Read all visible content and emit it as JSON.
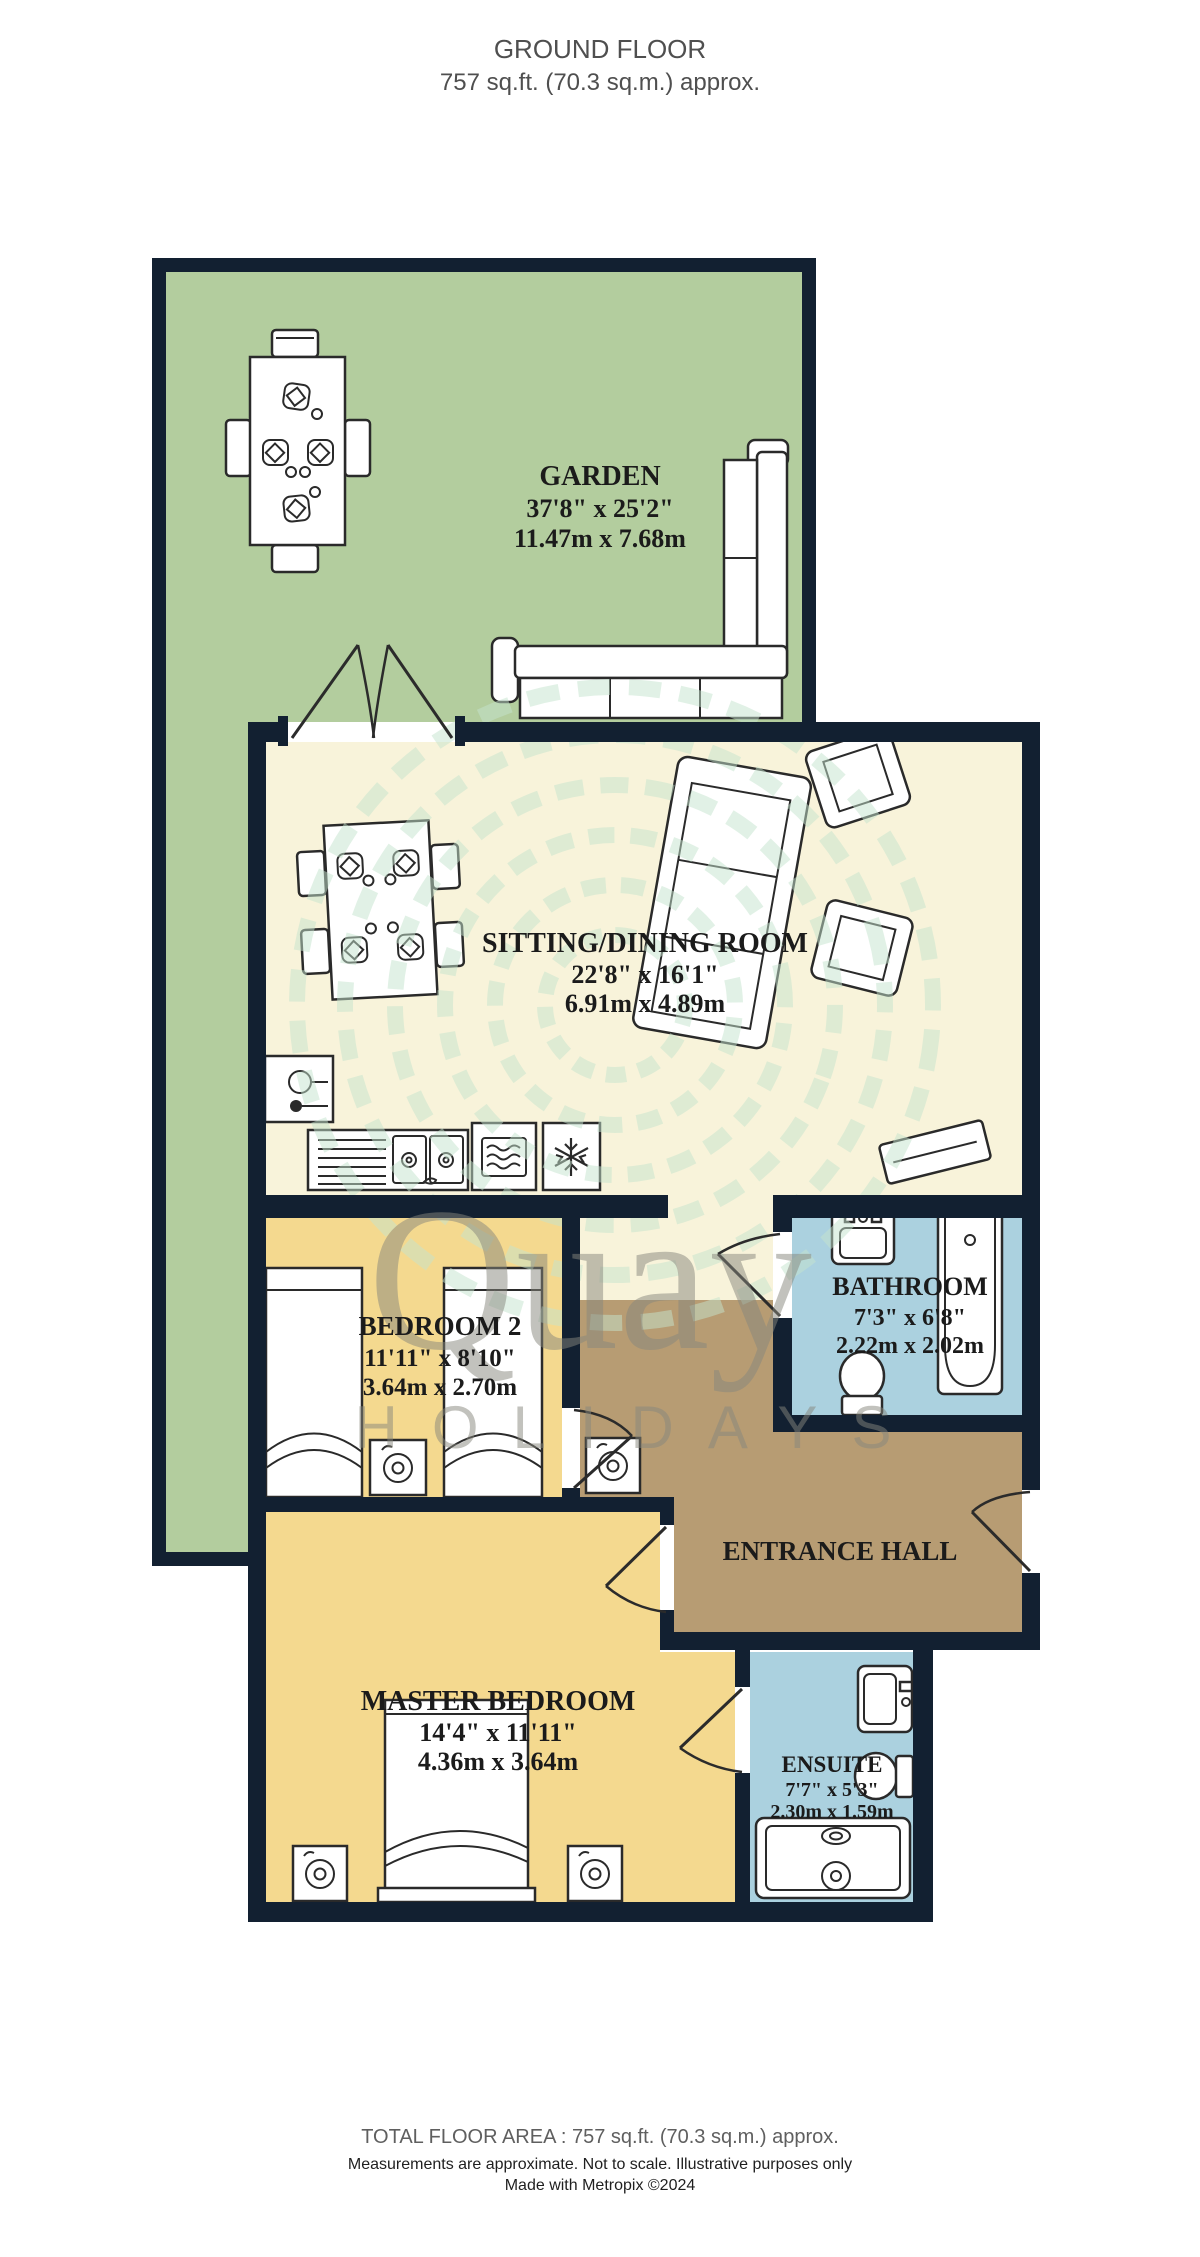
{
  "title": {
    "line1": "GROUND FLOOR",
    "line2": "757 sq.ft. (70.3 sq.m.) approx."
  },
  "rooms": {
    "garden": {
      "name": "GARDEN",
      "imperial": "37'8\"  x 25'2\"",
      "metric": "11.47m  x 7.68m"
    },
    "sitting": {
      "name": "SITTING/DINING ROOM",
      "imperial": "22'8\"  x 16'1\"",
      "metric": "6.91m  x 4.89m"
    },
    "bedroom2": {
      "name": "BEDROOM 2",
      "imperial": "11'11\"  x 8'10\"",
      "metric": "3.64m  x 2.70m"
    },
    "bathroom": {
      "name": "BATHROOM",
      "imperial": "7'3\"  x 6'8\"",
      "metric": "2.22m  x 2.02m"
    },
    "hall": {
      "name": "ENTRANCE HALL"
    },
    "master": {
      "name": "MASTER BEDROOM",
      "imperial": "14'4\"  x 11'11\"",
      "metric": "4.36m  x 3.64m"
    },
    "ensuite": {
      "name": "ENSUITE",
      "imperial": "7'7\"  x 5'3\"",
      "metric": "2.30m  x 1.59m"
    }
  },
  "watermark": {
    "brand": "Quay",
    "sub": "HOLIDAYS"
  },
  "footer": {
    "total": "TOTAL FLOOR AREA : 757 sq.ft. (70.3 sq.m.) approx.",
    "disclaimer": "Measurements are approximate.  Not to scale.  Illustrative purposes only",
    "credit": "Made with Metropix ©2024"
  },
  "colors": {
    "wall": "#122031",
    "garden": "#b3cd9e",
    "sitting_room": "#f8f3da",
    "bedroom": "#f4d98f",
    "bathroom": "#abd1df",
    "hall": "#b79c73",
    "watermark_gray": "#87877d",
    "watermark_green": "#c5e4ce"
  }
}
